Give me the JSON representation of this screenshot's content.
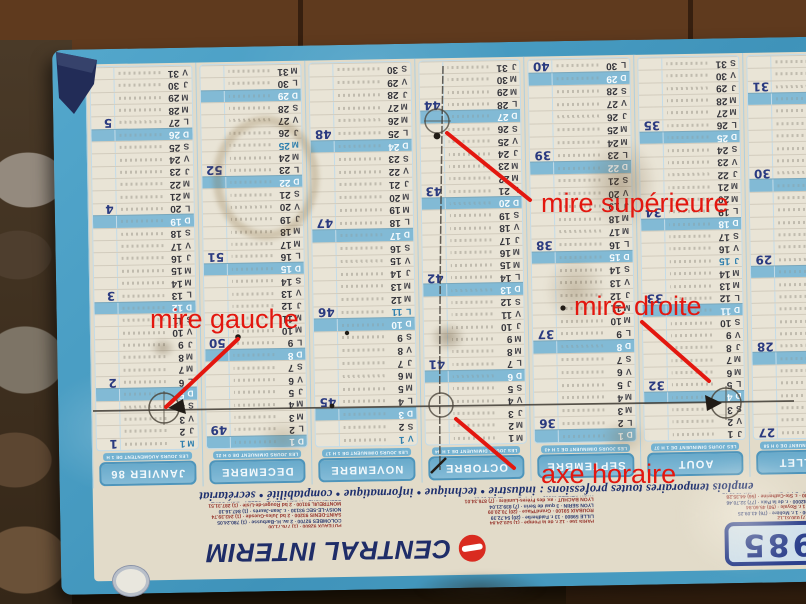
{
  "annotations": {
    "color": "#e3170f",
    "items": [
      {
        "id": "mire-superieure",
        "label": "mire supérieure"
      },
      {
        "id": "mire-gauche",
        "label": "mire gauche"
      },
      {
        "id": "mire-droite",
        "label": "mire droite"
      },
      {
        "id": "axe-horaire",
        "label": "axe horaire"
      }
    ]
  },
  "calendar": {
    "year": "1985",
    "brand": "CENTRAL INTERIM",
    "professions_line": "emplois temporaires toutes professions : industrie • technique • informatique • comptabilité • secrétariat",
    "months": [
      {
        "name": "JANVIER 86",
        "subtitle": "Les jours augmentent de 1 h 03 mn",
        "days": [
          "M 1",
          "J 2",
          "V 3",
          "S 4",
          "D 5",
          "L 6",
          "M 7",
          "M 8",
          "J 9",
          "V 10",
          "S 11",
          "D 12",
          "L 13",
          "M 14",
          "M 15",
          "J 16",
          "V 17",
          "S 18",
          "D 19",
          "L 20",
          "M 21",
          "M 22",
          "J 23",
          "V 24",
          "S 25",
          "D 26",
          "L 27",
          "M 28",
          "M 29",
          "J 30",
          "V 31"
        ],
        "weeks": {
          "1": 1,
          "6": 2,
          "13": 3,
          "20": 4,
          "27": 5
        },
        "holidays": [
          1
        ]
      },
      {
        "name": "DECEMBRE",
        "subtitle": "Les jours diminuent de 0 h 21 mn",
        "days": [
          "D 1",
          "L 2",
          "M 3",
          "M 4",
          "J 5",
          "V 6",
          "S 7",
          "D 8",
          "L 9",
          "M 10",
          "M 11",
          "J 12",
          "V 13",
          "S 14",
          "D 15",
          "L 16",
          "M 17",
          "M 18",
          "J 19",
          "V 20",
          "S 21",
          "D 22",
          "L 23",
          "M 24",
          "M 25",
          "J 26",
          "V 27",
          "S 28",
          "D 29",
          "L 30",
          "M 31"
        ],
        "weeks": {
          "2": 49,
          "9": 50,
          "16": 51,
          "23": 52
        },
        "holidays": [
          25
        ]
      },
      {
        "name": "NOVEMBRE",
        "subtitle": "Les jours diminuent de 1 h 17 mn",
        "days": [
          "V 1",
          "S 2",
          "D 3",
          "L 4",
          "M 5",
          "M 6",
          "J 7",
          "V 8",
          "S 9",
          "D 10",
          "L 11",
          "M 12",
          "M 13",
          "J 14",
          "V 15",
          "S 16",
          "D 17",
          "L 18",
          "M 19",
          "M 20",
          "J 21",
          "V 22",
          "S 23",
          "D 24",
          "L 25",
          "M 26",
          "M 27",
          "J 28",
          "V 29",
          "S 30"
        ],
        "weeks": {
          "4": 45,
          "11": 46,
          "18": 47,
          "25": 48
        },
        "holidays": [
          1,
          11
        ]
      },
      {
        "name": "OCTOBRE",
        "subtitle": "Les jours diminuent de 1 h 44 mn",
        "days": [
          "M 1",
          "M 2",
          "J 3",
          "V 4",
          "S 5",
          "D 6",
          "L 7",
          "M 8",
          "M 9",
          "J 10",
          "V 11",
          "S 12",
          "D 13",
          "L 14",
          "M 15",
          "M 16",
          "J 17",
          "V 18",
          "S 19",
          "D 20",
          "L 21",
          "M 22",
          "M 23",
          "J 24",
          "V 25",
          "S 26",
          "D 27",
          "L 28",
          "M 29",
          "M 30",
          "J 31"
        ],
        "weeks": {
          "7": 41,
          "14": 42,
          "21": 43,
          "28": 44
        },
        "holidays": []
      },
      {
        "name": "SEPTEMBRE",
        "subtitle": "Les jours diminuent de 1 h 43 mn",
        "days": [
          "D 1",
          "L 2",
          "M 3",
          "M 4",
          "J 5",
          "V 6",
          "S 7",
          "D 8",
          "L 9",
          "M 10",
          "M 11",
          "J 12",
          "V 13",
          "S 14",
          "D 15",
          "L 16",
          "M 17",
          "M 18",
          "J 19",
          "V 20",
          "S 21",
          "D 22",
          "L 23",
          "M 24",
          "M 25",
          "J 26",
          "V 27",
          "S 28",
          "D 29",
          "L 30"
        ],
        "weeks": {
          "2": 36,
          "9": 37,
          "16": 38,
          "23": 39,
          "30": 40
        },
        "holidays": []
      },
      {
        "name": "AOUT",
        "subtitle": "Les jours diminuent de 1 h 37 mn",
        "days": [
          "J 1",
          "V 2",
          "S 3",
          "D 4",
          "L 5",
          "M 6",
          "M 7",
          "J 8",
          "V 9",
          "S 10",
          "D 11",
          "L 12",
          "M 13",
          "M 14",
          "J 15",
          "V 16",
          "S 17",
          "D 18",
          "L 19",
          "M 20",
          "M 21",
          "J 22",
          "V 23",
          "S 24",
          "D 25",
          "L 26",
          "M 27",
          "M 28",
          "J 29",
          "V 30",
          "S 31"
        ],
        "weeks": {
          "5": 32,
          "12": 33,
          "19": 34,
          "26": 35
        },
        "holidays": [
          15
        ]
      },
      {
        "name": "JUILLET",
        "subtitle": "Les jours diminuent de 0 h 58 mn",
        "days": [
          "L 1",
          "M 2",
          "M 3",
          "J 4",
          "V 5",
          "S 6",
          "D 7",
          "L 8",
          "M 9",
          "M 10",
          "J 11",
          "V 12",
          "S 13",
          "D 14",
          "L 15",
          "M 16",
          "M 17",
          "J 18",
          "V 19",
          "S 20",
          "D 21",
          "L 22",
          "M 23",
          "M 24",
          "J 25",
          "V 26",
          "S 27",
          "D 28",
          "L 29",
          "M 30",
          "M 31"
        ],
        "weeks": {
          "1": 27,
          "8": 28,
          "15": 29,
          "22": 30,
          "29": 31
        },
        "holidays": [
          14
        ]
      }
    ],
    "agency_columns": [
      [
        "CHALINS 0600 · (7) 030.61.12",
        "GRENOBLE 38000 · 1 r. Molière · (76) 43.09.25",
        "ANNECY 74000 · 1 r. Royale · (50) 45.60.84",
        "SAINT-ETIENNE 42000 · r. de la Paix · (77) 32.70.46",
        "BORDEAUX 33000 · r. Ste-Catherine · (56) 44.35.28",
        "TOULOUSE 31000 · Bd de Strasbourg · (61) 62.80.17"
      ],
      [
        "PARIS 16e · 12 r. de la Pompe · (1) 520.24.84",
        "LILLE 59800 · 13 r. Faidherbe · (20) 54.72.39",
        "ROUBAIX 59100 · Grand'Place · (20) 70.20.09",
        "LYON SERIN · 3 quai de Serin · (7) 839.21.04",
        "LYON BACHUT · av. des Frères-Lumière · (7) 876.34.01",
        "LYON CENTRE 69002 · r. de la Barre · (7) 837.28.39"
      ],
      [
        "PUTEAUX 92800 · (1) 776.71.00",
        "COLOMBES 92700 · 2 av. H.-Barbusse · (1) 780.24.05",
        "SAINT-DENIS 93200 · 2 bd Jules-Guesde · (1) 243.39.74",
        "NOISY-LE-SEC 93130 · r. Jean-Jaurès · (1) 847.16.10",
        "MONTREUIL 93100 · 2 bd Rouget-de-Lisle · (1) 287.31.51",
        "REPUBLIQUE · ALESIA · ITALIE · OPERA · BOULOGNE"
      ]
    ]
  },
  "colors": {
    "board_blue": "#4a9fc5",
    "sheet_cream": "#e2dbc9",
    "label_blue": "#74b2d1",
    "sunday_blue": "#82bad5",
    "navy_text": "#2b3f8c",
    "annotation_red": "#e3170f",
    "pencil": "#3e3a33"
  }
}
